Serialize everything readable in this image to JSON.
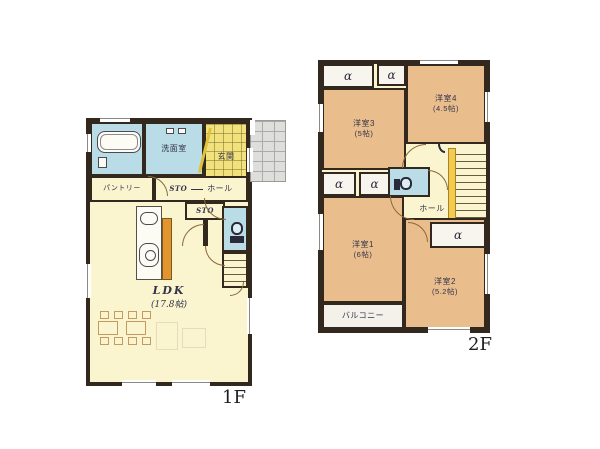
{
  "colors": {
    "wall": "#32281E",
    "floor_cream": "#FAF4CF",
    "room_orange": "#E9BE8C",
    "wet_blue": "#B9DCE6",
    "genkan_yellow": "#F1E27E",
    "porch_gray": "#DEDEDC",
    "kitchen_orange": "#E2952F",
    "stair_yellow": "#F3CB4F",
    "balcony_white": "#F3F1EA"
  },
  "floor1": {
    "name": "1F",
    "washroom": "洗面室",
    "genkan": "玄関",
    "pantry": "パントリー",
    "sto": "STO",
    "hall": "ホール",
    "sto2": "STO",
    "ldk_name": "LDK",
    "ldk_size": "(17.8帖)"
  },
  "floor2": {
    "name": "2F",
    "room3_name": "洋室3",
    "room3_size": "(5帖)",
    "room4_name": "洋室4",
    "room4_size": "(4.5帖)",
    "room1_name": "洋室1",
    "room1_size": "(6帖)",
    "room2_name": "洋室2",
    "room2_size": "(5.2帖)",
    "hall": "ホール",
    "balcony": "バルコニー",
    "closet_symbol": "α"
  }
}
